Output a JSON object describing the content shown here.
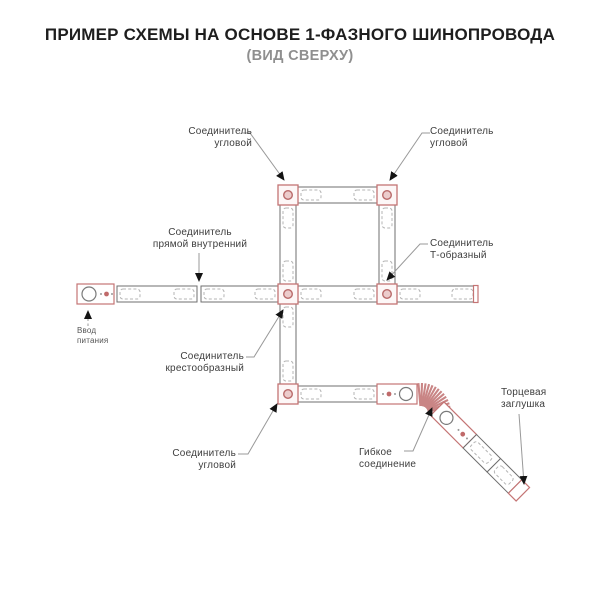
{
  "title": "ПРИМЕР СХЕМЫ НА ОСНОВЕ 1-ФАЗНОГО ШИНОПРОВОДА",
  "subtitle": "(ВИД СВЕРХУ)",
  "labels": {
    "corner_top_left": {
      "lines": [
        "Соединитель",
        "угловой"
      ]
    },
    "corner_top_right": {
      "lines": [
        "Соединитель",
        "угловой"
      ]
    },
    "straight_internal": {
      "lines": [
        "Соединитель",
        "прямой внутренний"
      ]
    },
    "t_shaped": {
      "lines": [
        "Соединитель",
        "Т-образный"
      ]
    },
    "cross": {
      "lines": [
        "Соединитель",
        "крестообразный"
      ]
    },
    "corner_bottom": {
      "lines": [
        "Соединитель",
        "угловой"
      ]
    },
    "flexible": {
      "lines": [
        "Гибкое",
        "соединение"
      ]
    },
    "end_cap": {
      "lines": [
        "Торцевая",
        "заглушка"
      ]
    },
    "power_input": {
      "lines": [
        "Ввод",
        "питания"
      ]
    }
  },
  "colors": {
    "accent_red": "#c47474",
    "connector_circle_fill": "#eccccc",
    "track_stroke": "#6f6f6f",
    "dashed_inner": "#b5b5b5",
    "leader_line": "#999999",
    "title_text": "#1e1e1e",
    "subtitle_text": "#8f8f8f",
    "label_text": "#3d3d3d"
  }
}
